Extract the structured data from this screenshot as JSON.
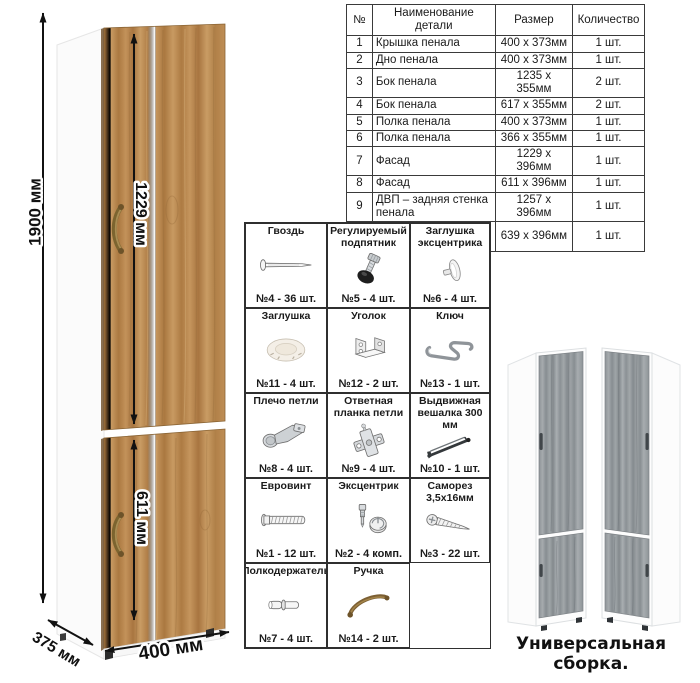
{
  "dimensions": {
    "height": "1900 мм",
    "upper_door": "1229 мм",
    "lower_door": "611 мм",
    "depth": "375 мм",
    "width": "400 мм"
  },
  "parts_table": {
    "headers": [
      "№",
      "Наименование детали",
      "Размер",
      "Количество"
    ],
    "rows": [
      [
        "1",
        "Крышка пенала",
        "400 х 373мм",
        "1 шт."
      ],
      [
        "2",
        "Дно пенала",
        "400 х 373мм",
        "1 шт."
      ],
      [
        "3",
        "Бок пенала",
        "1235 х 355мм",
        "2 шт."
      ],
      [
        "4",
        "Бок пенала",
        "617 х 355мм",
        "2 шт."
      ],
      [
        "5",
        "Полка пенала",
        "400 х 373мм",
        "1 шт."
      ],
      [
        "6",
        "Полка пенала",
        "366 х 355мм",
        "1 шт."
      ],
      [
        "7",
        "Фасад",
        "1229 х 396мм",
        "1 шт."
      ],
      [
        "8",
        "Фасад",
        "611 х 396мм",
        "1 шт."
      ],
      [
        "9",
        "ДВП – задняя стенка пенала",
        "1257 х 396мм",
        "1 шт."
      ],
      [
        "10",
        "ДВП – задняя стенка пенала",
        "639 х 396мм",
        "1 шт."
      ]
    ]
  },
  "hardware": {
    "items": [
      {
        "label": "Гвоздь",
        "count": "№4 - 36 шт.",
        "icon": "nail-icon"
      },
      {
        "label": "Регулируемый подпятник",
        "count": "№5 - 4 шт.",
        "icon": "adjustable-foot-icon"
      },
      {
        "label": "Заглушка эксцентрика",
        "count": "№6 - 4 шт.",
        "icon": "cam-cover-icon"
      },
      {
        "label": "Заглушка",
        "count": "№11 - 4 шт.",
        "icon": "cap-icon"
      },
      {
        "label": "Уголок",
        "count": "№12 - 2 шт.",
        "icon": "corner-bracket-icon"
      },
      {
        "label": "Ключ",
        "count": "№13 - 1 шт.",
        "icon": "hex-key-icon"
      },
      {
        "label": "Плечо петли",
        "count": "№8 - 4 шт.",
        "icon": "hinge-arm-icon"
      },
      {
        "label": "Ответная планка петли",
        "count": "№9 - 4 шт.",
        "icon": "hinge-plate-icon"
      },
      {
        "label": "Выдвижная вешалка 300 мм",
        "count": "№10 - 1 шт.",
        "icon": "pullout-hanger-icon"
      },
      {
        "label": "Евровинт",
        "count": "№1 - 12 шт.",
        "icon": "confirmat-screw-icon"
      },
      {
        "label": "Эксцентрик",
        "count": "№2 - 4 комп.",
        "icon": "cam-lock-icon"
      },
      {
        "label": "Саморез 3,5х16мм",
        "count": "№3 - 22 шт.",
        "icon": "self-tapping-screw-icon"
      },
      {
        "label": "Полкодержатель",
        "count": "№7 - 4 шт.",
        "icon": "shelf-pin-icon"
      },
      {
        "label": "Ручка",
        "count": "№14 - 2 шт.",
        "icon": "handle-icon"
      }
    ]
  },
  "footer": {
    "caption": "Универсальная сборка."
  },
  "colors": {
    "wood": "#b5834e",
    "wood_dark": "#8d6434",
    "wood_light": "#cfa76d",
    "gray_wood": "#9aa0a4",
    "handle_bronze": "#8a6b3a",
    "dimension_line": "#111111"
  }
}
